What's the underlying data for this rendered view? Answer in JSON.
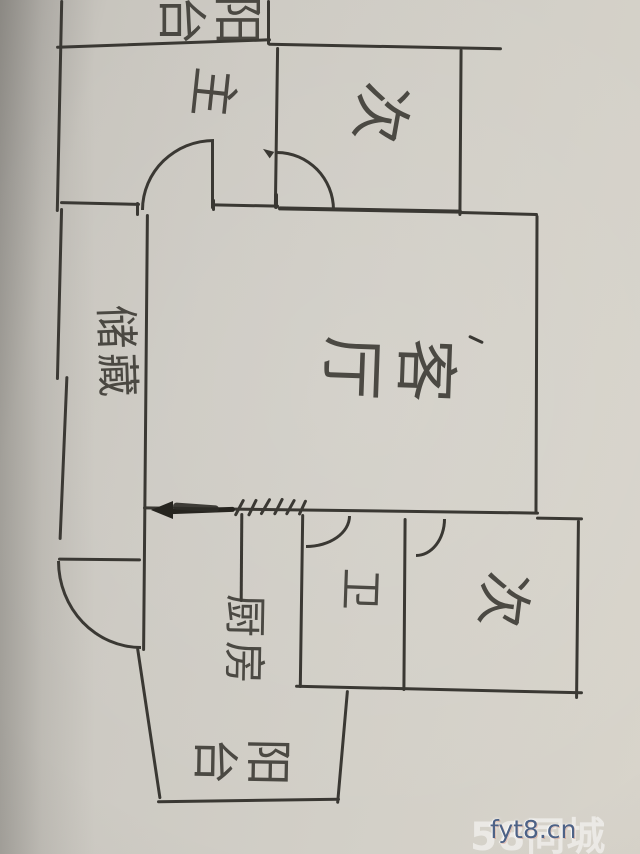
{
  "meta": {
    "kind": "hand-drawn apartment floor plan sketch on paper"
  },
  "rooms": {
    "balcony_top": {
      "label": "阳台",
      "name": "balcony (top)"
    },
    "master": {
      "label": "主",
      "name": "master bedroom"
    },
    "secondary_top": {
      "label": "次",
      "name": "secondary bedroom (top)"
    },
    "living": {
      "label": "客厅",
      "name": "living room"
    },
    "storage": {
      "label": "储藏",
      "name": "storage"
    },
    "bathroom": {
      "label": "卫",
      "name": "bathroom"
    },
    "secondary_bottom": {
      "label": "次",
      "name": "secondary bedroom (bottom)"
    },
    "kitchen": {
      "label": "厨房",
      "name": "kitchen"
    },
    "balcony_bottom": {
      "label": "阳台",
      "name": "balcony (bottom)"
    }
  },
  "annotations": {
    "entry_arrow": "arrow-left",
    "window_hatches": "hatch-marks on lower wall",
    "doors": [
      "master",
      "secondary-top",
      "entry",
      "bathroom",
      "secondary-bottom"
    ]
  },
  "watermark": {
    "site_text": "58同城",
    "overlay_text": "fyt8.cn"
  },
  "colors": {
    "ink": "#3a3833",
    "paper": "#cdcac3",
    "watermark_overlay": "#4d6286"
  }
}
